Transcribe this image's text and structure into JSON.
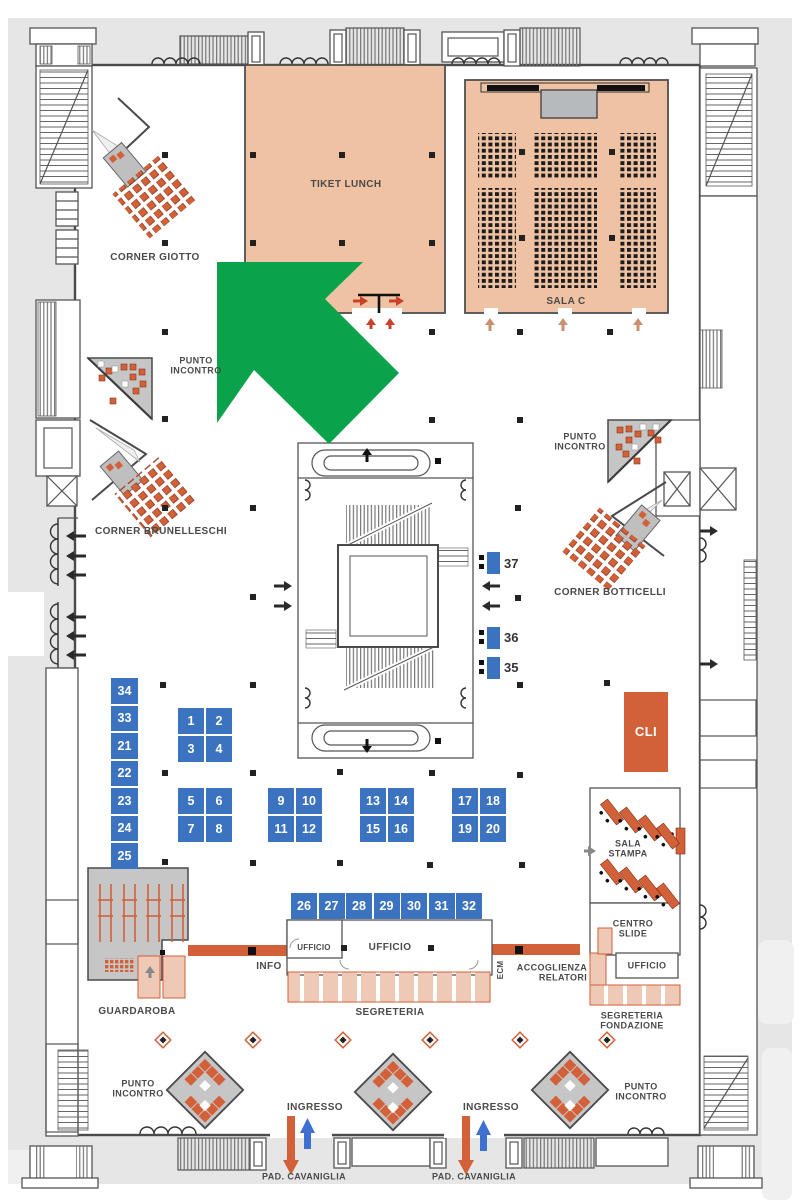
{
  "colors": {
    "wall": "#4a4a4a",
    "label": "#4a4a4a",
    "tan": "#eec2a2",
    "stage": "#b7babc",
    "blue": "#3b73c0",
    "orange": "#d2613a",
    "red_arrow": "#c9412a",
    "salmon": "#edc9b6",
    "room_gray": "#c6c6c6",
    "green": "#0ba24c",
    "margin": "#e6e6e6",
    "blue_arrow": "#3f6fd1",
    "tan_arrow": "#c9916f",
    "road": "#f0f0f0"
  },
  "labels": {
    "corner_giotto": "CORNER GIOTTO",
    "tiket_lunch": "TIKET LUNCH",
    "sala_c": "SALA C",
    "punto_line1": "PUNTO",
    "punto_line2": "INCONTRO",
    "corner_brunelleschi": "CORNER BRUNELLESCHI",
    "corner_botticelli": "CORNER BOTTICELLI",
    "cli": "CLI",
    "sala_stampa_line1": "SALA",
    "sala_stampa_line2": "STAMPA",
    "centro_slide_line1": "CENTRO",
    "centro_slide_line2": "SLIDE",
    "ufficio": "UFFICIO",
    "info": "INFO",
    "segreteria": "SEGRETERIA",
    "ecm": "ECM",
    "accoglienza_line1": "ACCOGLIENZA",
    "accoglienza_line2": "RELATORI",
    "segreteria_fondazione_line1": "SEGRETERIA",
    "segreteria_fondazione_line2": "FONDAZIONE",
    "guardaroba": "GUARDAROBA",
    "ingresso": "INGRESSO",
    "pad_cavaniglia": "PAD. CAVANIGLIA"
  },
  "stands": {
    "left_column": [
      "34",
      "33",
      "21",
      "22",
      "23",
      "24",
      "25"
    ],
    "group_1_4": [
      "1",
      "2",
      "3",
      "4"
    ],
    "group_5_8": [
      "5",
      "6",
      "7",
      "8"
    ],
    "group_9_12": [
      "9",
      "10",
      "11",
      "12"
    ],
    "group_13_16": [
      "13",
      "14",
      "15",
      "16"
    ],
    "group_17_20": [
      "17",
      "18",
      "19",
      "20"
    ],
    "bottom_row": [
      "26",
      "27",
      "28",
      "29",
      "30",
      "31",
      "32"
    ],
    "tower": [
      "37",
      "36",
      "35"
    ]
  }
}
